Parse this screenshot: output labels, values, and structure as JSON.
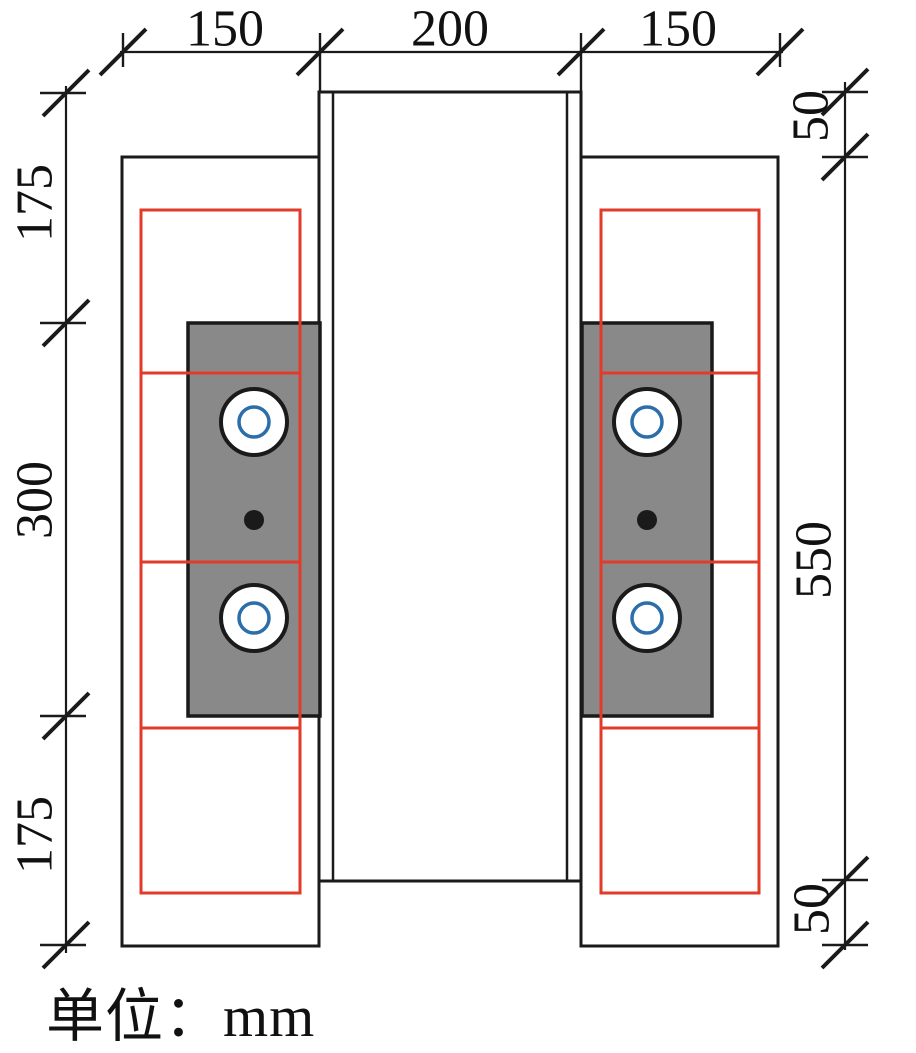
{
  "caption": {
    "text": "单位：mm"
  },
  "colors": {
    "line": "#1a1a1a",
    "red": "#e23b2a",
    "blue": "#2b6ea9",
    "gray_fill": "#898989",
    "white": "#ffffff",
    "text": "#111111"
  },
  "drawing": {
    "column": {
      "x": 319,
      "y": 92,
      "w": 262,
      "h": 789,
      "inner_inset": 14
    },
    "side_plates": [
      {
        "side": "left",
        "x": 122,
        "y": 157,
        "w": 197,
        "h": 789
      },
      {
        "side": "right",
        "x": 581,
        "y": 157,
        "w": 197,
        "h": 789
      }
    ],
    "splice_plates": [
      {
        "side": "left",
        "x": 188,
        "y": 323,
        "w": 132,
        "h": 393
      },
      {
        "side": "right",
        "x": 582,
        "y": 323,
        "w": 130,
        "h": 393
      }
    ],
    "red_frames": [
      {
        "side": "left",
        "x": 141,
        "y": 210,
        "w": 159,
        "h": 683,
        "dividers_y": [
          373,
          562,
          728
        ]
      },
      {
        "side": "right",
        "x": 601,
        "y": 210,
        "w": 158,
        "h": 683,
        "dividers_y": [
          373,
          562,
          728
        ]
      }
    ],
    "bolts": [
      {
        "cx": 254,
        "cy": 422
      },
      {
        "cx": 254,
        "cy": 618
      },
      {
        "cx": 647,
        "cy": 422
      },
      {
        "cx": 647,
        "cy": 618
      }
    ],
    "bolt_style": {
      "outer_r": 33,
      "ring_r": 15
    },
    "center_dots": [
      {
        "cx": 254,
        "cy": 520
      },
      {
        "cx": 647,
        "cy": 520
      }
    ],
    "dot_r": 10,
    "slash_half": 23,
    "label_font_size": 52,
    "dimensions": [
      {
        "id": "top",
        "orientation": "h",
        "line_pos": 52,
        "from": 120,
        "to": 783,
        "ticks": [
          {
            "pos": 123,
            "bar": [
              33,
              67
            ]
          },
          {
            "pos": 320,
            "bar": [
              33,
              92
            ]
          },
          {
            "pos": 581,
            "bar": [
              33,
              92
            ]
          },
          {
            "pos": 780,
            "bar": [
              33,
              67
            ]
          }
        ],
        "labels": [
          {
            "text": "150",
            "cx": 225,
            "cy": 29
          },
          {
            "text": "200",
            "cx": 450,
            "cy": 29
          },
          {
            "text": "150",
            "cx": 678,
            "cy": 29
          }
        ]
      },
      {
        "id": "left",
        "orientation": "v",
        "line_pos": 66,
        "from": 86,
        "to": 953,
        "ticks": [
          {
            "pos": 93,
            "bar": [
              40,
              86
            ]
          },
          {
            "pos": 323,
            "bar": [
              40,
              86
            ]
          },
          {
            "pos": 716,
            "bar": [
              40,
              86
            ]
          },
          {
            "pos": 945,
            "bar": [
              40,
              86
            ]
          }
        ],
        "labels": [
          {
            "text": "175",
            "cx": 35,
            "cy": 203
          },
          {
            "text": "300",
            "cx": 35,
            "cy": 500
          },
          {
            "text": "175",
            "cx": 35,
            "cy": 835
          }
        ]
      },
      {
        "id": "right",
        "orientation": "v",
        "line_pos": 845,
        "from": 82,
        "to": 950,
        "ticks": [
          {
            "pos": 92,
            "bar": [
              822,
              868
            ]
          },
          {
            "pos": 157,
            "bar": [
              822,
              868
            ]
          },
          {
            "pos": 880,
            "bar": [
              822,
              868
            ]
          },
          {
            "pos": 945,
            "bar": [
              822,
              868
            ]
          }
        ],
        "labels": [
          {
            "text": "50",
            "cx": 811,
            "cy": 116
          },
          {
            "text": "550",
            "cx": 814,
            "cy": 560
          },
          {
            "text": "50",
            "cx": 812,
            "cy": 909
          }
        ]
      }
    ]
  }
}
